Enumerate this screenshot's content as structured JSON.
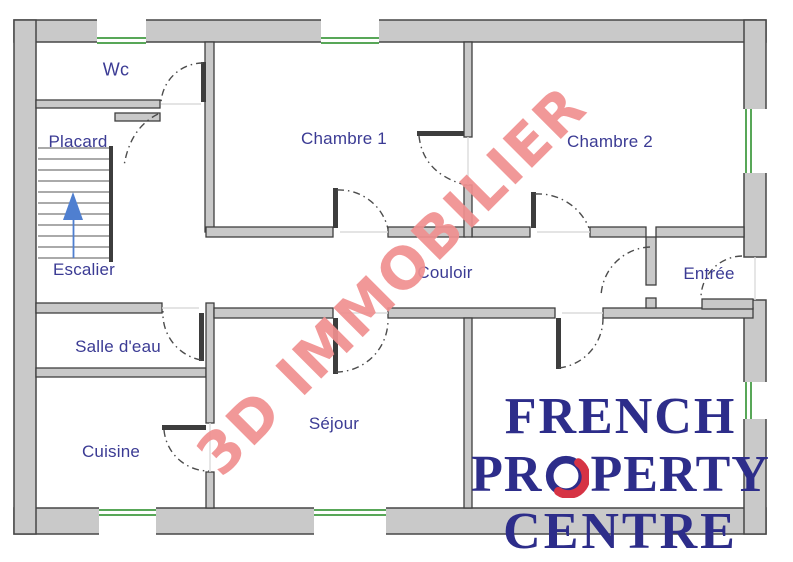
{
  "floor_plan": {
    "rooms": [
      {
        "id": "wc",
        "label": "Wc"
      },
      {
        "id": "placard",
        "label": "Placard"
      },
      {
        "id": "escalier",
        "label": "Escalier"
      },
      {
        "id": "salle_d_eau",
        "label": "Salle d'eau"
      },
      {
        "id": "cuisine",
        "label": "Cuisine"
      },
      {
        "id": "chambre_1",
        "label": "Chambre 1"
      },
      {
        "id": "chambre_2",
        "label": "Chambre 2"
      },
      {
        "id": "couloir",
        "label": "Couloir"
      },
      {
        "id": "entree",
        "label": "Entrée"
      },
      {
        "id": "sejour",
        "label": "Séjour"
      }
    ],
    "colors": {
      "wall_fill": "#c9c9c9",
      "wall_outline": "#474747",
      "window_green": "#58a758",
      "room_label": "#3b3b94",
      "stair_arrow_blue": "#4f7fd0",
      "door_arc": "#4c4c4c",
      "background": "#ffffff"
    }
  },
  "watermark": {
    "text": "3D IMMOBILIER",
    "color": "#f09090"
  },
  "logo": {
    "line1": "FRENCH",
    "line2": "PROPERTY",
    "line2_prefix": "PR",
    "line2_suffix": "PERTY",
    "line3": "CENTRE",
    "navy": "#2d2d8a",
    "red": "#d63344"
  }
}
